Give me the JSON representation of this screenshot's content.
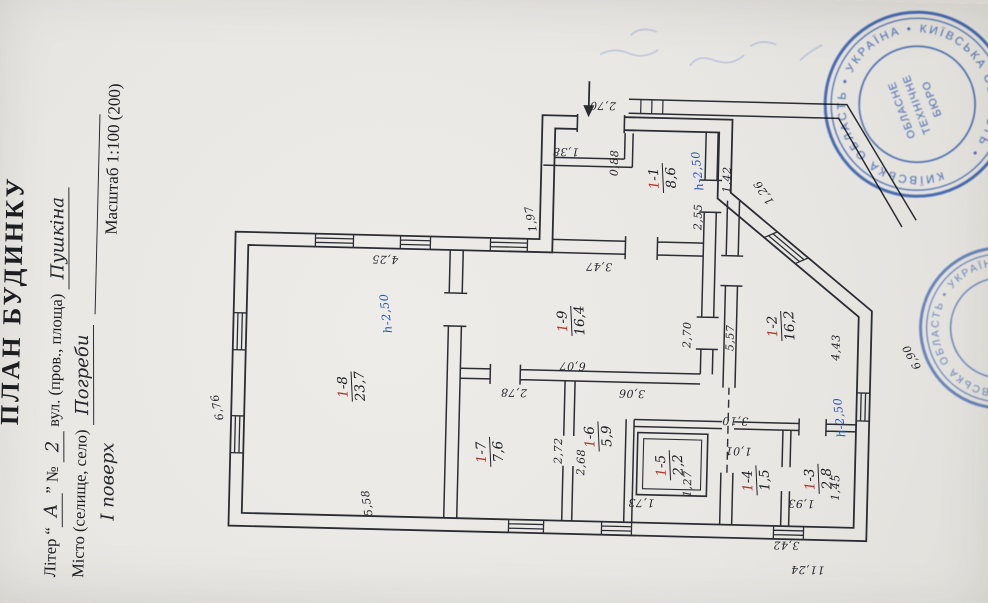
{
  "title_block": {
    "title": "ПЛАН БУДИНКУ",
    "liter_label": "Літер “",
    "liter_value": "А",
    "liter_close": "”  №",
    "number_value": "2",
    "street_label": "вул. (пров., площа)",
    "street_value": "Пушкіна",
    "city_label": "Місто (селище, село)",
    "city_value": "Погреби",
    "floor_value": "І поверх",
    "scale_label": "Масштаб 1:100 (200)"
  },
  "plan": {
    "rooms": [
      {
        "num": "1-8",
        "area": "23,7",
        "x": 222,
        "y": 370
      },
      {
        "num": "1-9",
        "area": "16,4",
        "x": 293,
        "y": 588
      },
      {
        "num": "1-7",
        "area": "7,6",
        "x": 160,
        "y": 510
      },
      {
        "num": "1-6",
        "area": "5,9",
        "x": 178,
        "y": 618
      },
      {
        "num": "1-5",
        "area": "2,2",
        "x": 151,
        "y": 690
      },
      {
        "num": "1-1",
        "area": "8,6",
        "x": 438,
        "y": 676
      },
      {
        "num": "1-2",
        "area": "16,2",
        "x": 293,
        "y": 798
      },
      {
        "num": "1-4",
        "area": "1,5",
        "x": 138,
        "y": 777
      },
      {
        "num": "1-3",
        "area": "2,8",
        "x": 141,
        "y": 839
      }
    ],
    "dimensions": [
      {
        "t": "6,76",
        "x": 198,
        "y": 236,
        "r": "h",
        "tilt": -14
      },
      {
        "t": "5,58",
        "x": 106,
        "y": 388,
        "r": "h",
        "tilt": -10
      },
      {
        "t": "4,25",
        "x": 350,
        "y": 400,
        "r": "v"
      },
      {
        "t": "6,07",
        "x": 248,
        "y": 590,
        "r": "v"
      },
      {
        "t": "2,70",
        "x": 282,
        "y": 704,
        "r": "h"
      },
      {
        "t": "5,57",
        "x": 280,
        "y": 747,
        "r": "h"
      },
      {
        "t": "2,78",
        "x": 220,
        "y": 532,
        "r": "v"
      },
      {
        "t": "2,72",
        "x": 163,
        "y": 578,
        "r": "h"
      },
      {
        "t": "2,68",
        "x": 152,
        "y": 601,
        "r": "h"
      },
      {
        "t": "3,06",
        "x": 222,
        "y": 650,
        "r": "v"
      },
      {
        "t": "1,73",
        "x": 113,
        "y": 662,
        "r": "v"
      },
      {
        "t": "1,27",
        "x": 133,
        "y": 708,
        "r": "h"
      },
      {
        "t": "3,47",
        "x": 348,
        "y": 614,
        "r": "v"
      },
      {
        "t": "2,55",
        "x": 400,
        "y": 712,
        "r": "h"
      },
      {
        "t": "1,97",
        "x": 394,
        "y": 545,
        "r": "h",
        "tilt": -12
      },
      {
        "t": "1,38",
        "x": 462,
        "y": 578,
        "r": "v"
      },
      {
        "t": "0,88",
        "x": 452,
        "y": 627,
        "r": "h"
      },
      {
        "t": "2,70",
        "x": 509,
        "y": 614,
        "r": "v"
      },
      {
        "t": "1,42",
        "x": 438,
        "y": 740,
        "r": "h"
      },
      {
        "t": "1,26",
        "x": 426,
        "y": 777,
        "r": "h",
        "tilt": -35
      },
      {
        "t": "3,10",
        "x": 197,
        "y": 754,
        "r": "v"
      },
      {
        "t": "4,43",
        "x": 273,
        "y": 853,
        "r": "h"
      },
      {
        "t": "6,90",
        "x": 265,
        "y": 929,
        "r": "h",
        "tilt": -30
      },
      {
        "t": "1,01",
        "x": 167,
        "y": 758,
        "r": "v"
      },
      {
        "t": "1,93",
        "x": 116,
        "y": 822,
        "r": "v"
      },
      {
        "t": "1,45",
        "x": 133,
        "y": 856,
        "r": "h"
      },
      {
        "t": "3,42",
        "x": 74,
        "y": 808,
        "r": "v"
      },
      {
        "t": "11,24",
        "x": 50,
        "y": 830,
        "r": "v"
      }
    ],
    "heights": [
      {
        "t": "h-2,50",
        "x": 296,
        "y": 402,
        "tilt": -8
      },
      {
        "t": "h-2,50",
        "x": 446,
        "y": 710,
        "tilt": -8
      },
      {
        "t": "h-2,50",
        "x": 203,
        "y": 858,
        "tilt": -8
      }
    ]
  },
  "stamps": {
    "ring_text": "КИЇВСЬКА ОБЛАСТЬ • УКРАЇНА • КИЇВСЬКА ОБЛАСТЬ •",
    "center_line1": "ОБЛАСНЕ",
    "center_line2": "ТЕХНІЧНЕ",
    "center_line3": "БЮРО",
    "ring_text2": "КИЇВСЬКА ОБЛАСТЬ • УКРАЇНА •"
  }
}
